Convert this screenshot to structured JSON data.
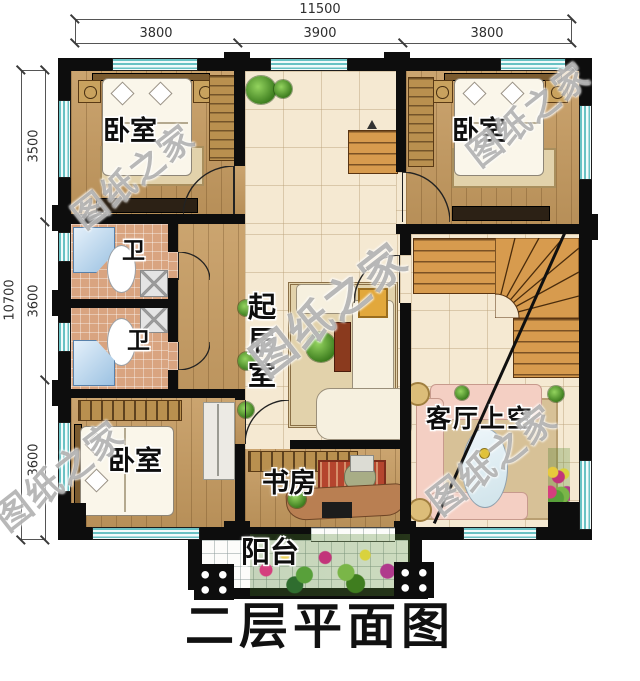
{
  "title": "二层平面图",
  "watermark": "图纸之家",
  "dim_top": {
    "total": "11500",
    "segments": [
      "3800",
      "3900",
      "3800"
    ]
  },
  "dim_left": {
    "total": "10700",
    "segments": [
      "3500",
      "3600",
      "3600"
    ]
  },
  "rooms": {
    "bedroom_tl": "卧室",
    "bedroom_tr": "卧室",
    "bedroom_bl": "卧室",
    "bath_top": "卫",
    "bath_bottom": "卫",
    "living": "起居室",
    "study": "书房",
    "void": "客厅上空",
    "balcony": "阳台"
  },
  "colors": {
    "wall": "#0d0d0d",
    "window_teal": "#69c2c4",
    "wood_floor": "#c59a5f",
    "tile_cream": "#f5e9d2",
    "bath_tile": "#d9a480",
    "stair_wood": "#d79b4e"
  }
}
